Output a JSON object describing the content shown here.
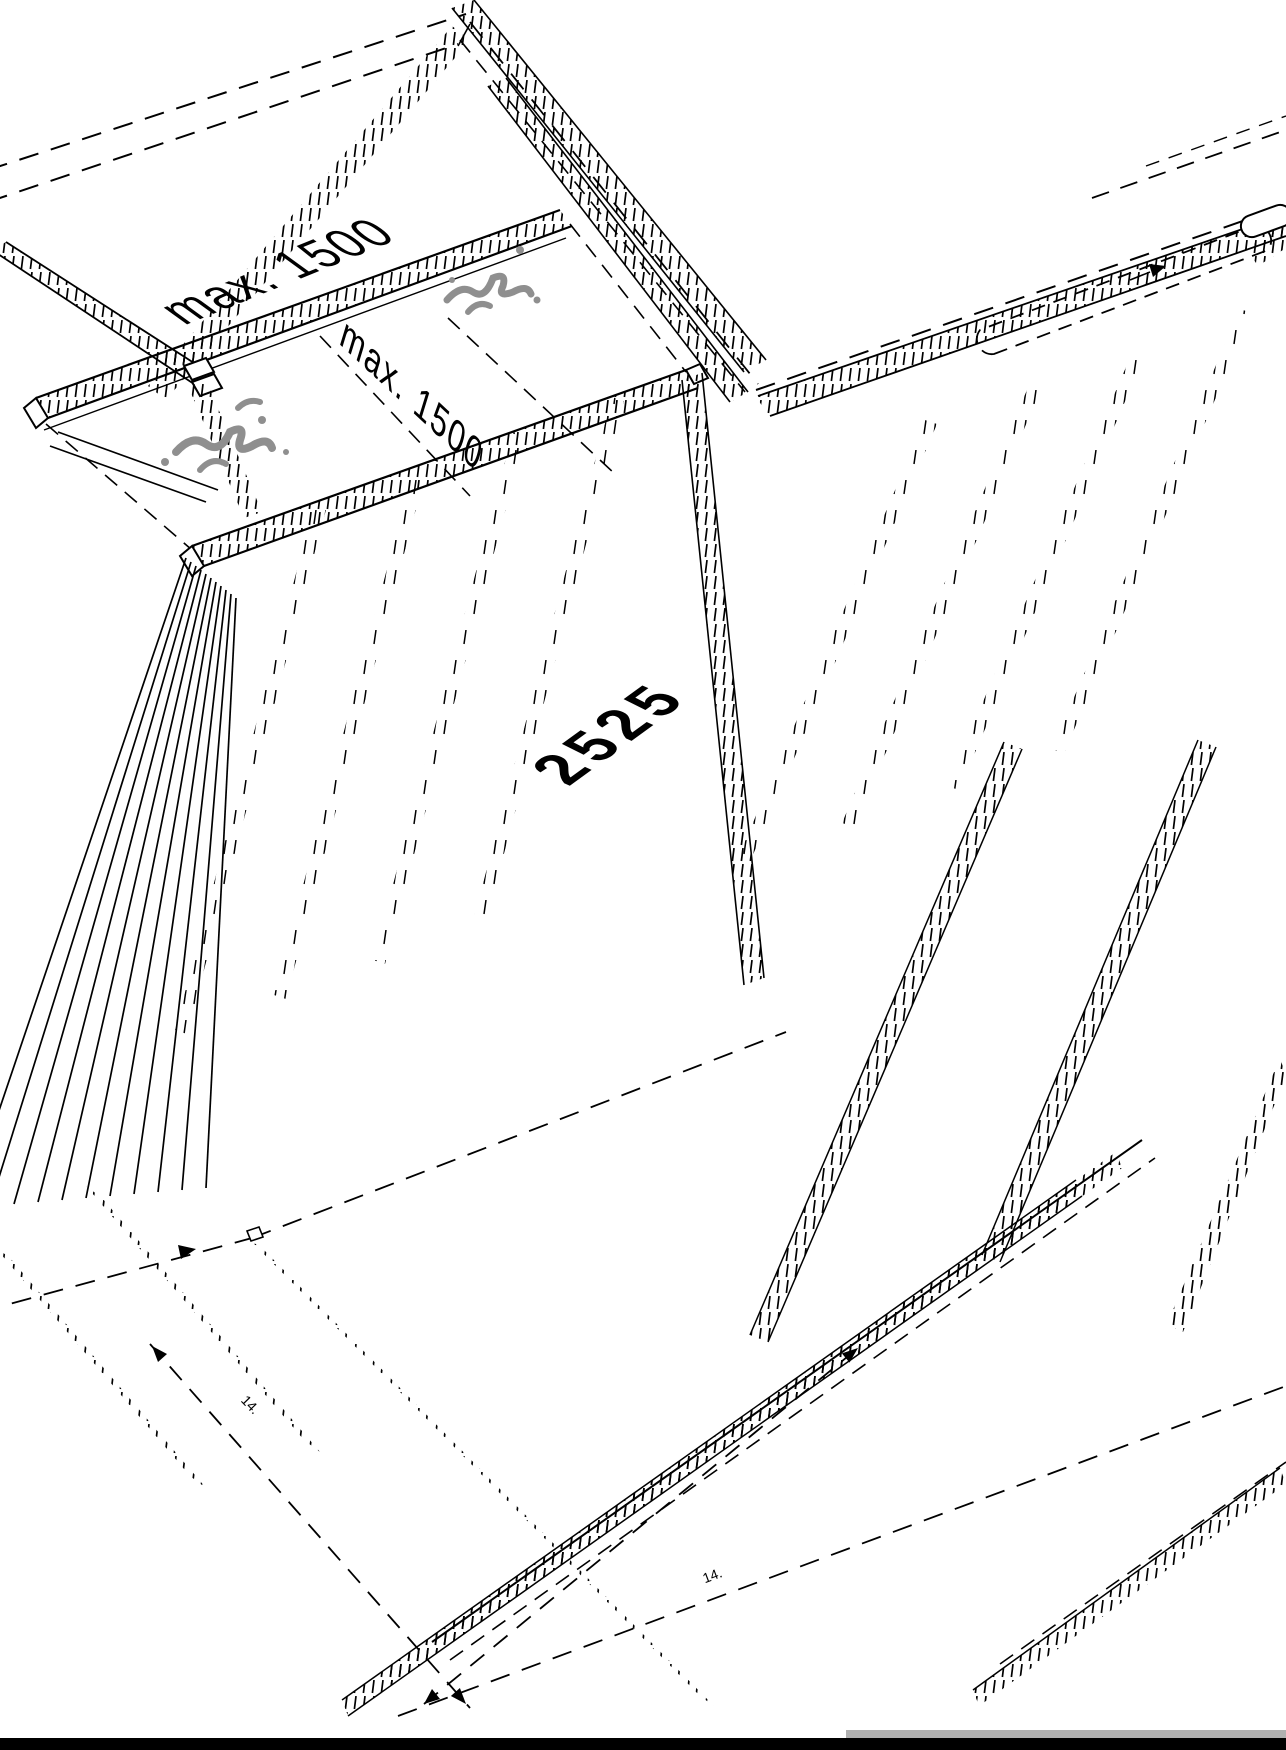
{
  "drawing": {
    "labels": {
      "dim_top": "max. 1500",
      "dim_mid": "max. 1500",
      "panel_length": "2525",
      "tick_note_left": "14.",
      "tick_note_right": "14."
    },
    "colors": {
      "line": "#000000",
      "spray_gray": "#8f8f8f",
      "footer_bar": "#000000",
      "footer_strip": "#b0b0b0",
      "background": "#ffffff"
    }
  }
}
